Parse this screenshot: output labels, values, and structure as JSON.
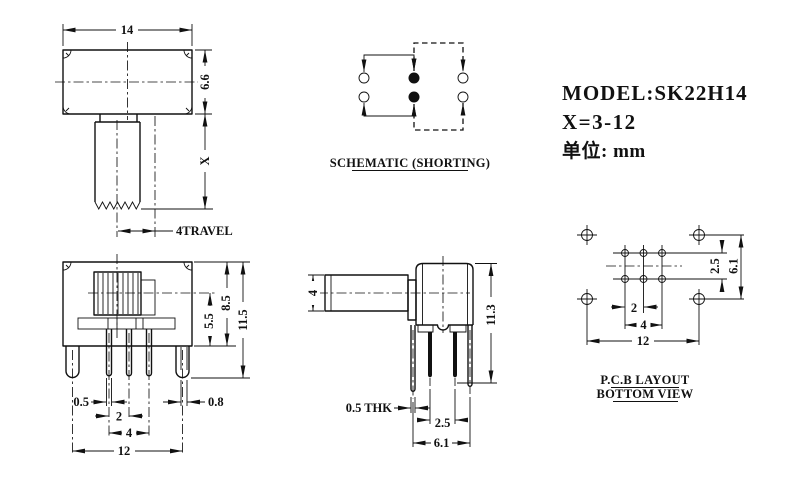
{
  "drawing": {
    "title_block": {
      "model": "MODEL:SK22H14",
      "x_range": "X=3-12",
      "unit_label": "单位: mm"
    },
    "schematic": {
      "caption": "SCHEMATIC (SHORTING)"
    },
    "top_view": {
      "dim_width": "14",
      "dim_depth": "6.6",
      "dim_stem": "X",
      "dim_travel": "4TRAVEL"
    },
    "front_view": {
      "dim_body_h": "8.5",
      "dim_lower_h": "5.5",
      "dim_total_h": "11.5",
      "dim_pin_thk": "0.5",
      "dim_pin_pitch": "2",
      "dim_pin_span": "4",
      "dim_mount_span": "12",
      "dim_bracket": "0.8"
    },
    "side_view": {
      "dim_knob": "4",
      "dim_total_h": "11.3",
      "dim_thk": "0.5 THK",
      "dim_pin_pitch": "2.5",
      "dim_pin_span": "6.1"
    },
    "pcb": {
      "caption_line1": "P.C.B LAYOUT",
      "caption_line2": "BOTTOM VIEW",
      "dim_row_pitch": "2.5",
      "dim_row_span": "6.1",
      "dim_col_pitch": "2",
      "dim_col_span": "4",
      "dim_mount_span": "12"
    }
  }
}
